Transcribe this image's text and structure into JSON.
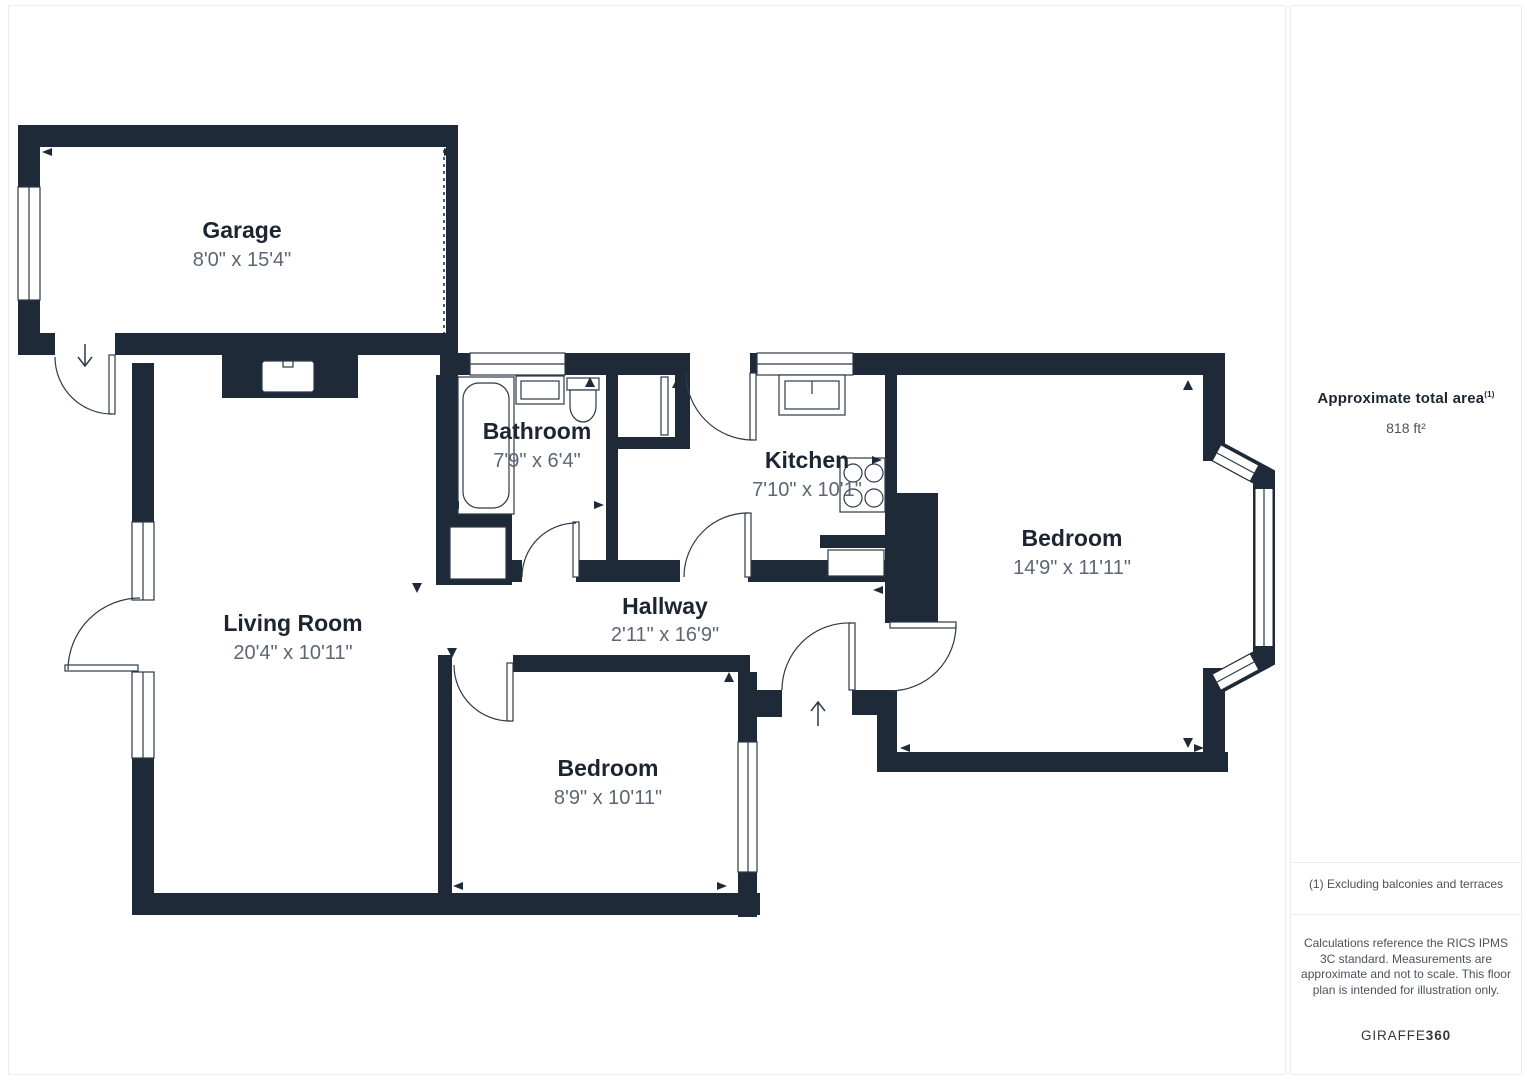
{
  "plan": {
    "wall_color": "#1f2a38",
    "rooms": [
      {
        "id": "garage",
        "name": "Garage",
        "dims": "8'0\" x 15'4\""
      },
      {
        "id": "bathroom",
        "name": "Bathroom",
        "dims": "7'9\" x 6'4\""
      },
      {
        "id": "kitchen",
        "name": "Kitchen",
        "dims": "7'10\" x 10'1\""
      },
      {
        "id": "bedroom-1",
        "name": "Bedroom",
        "dims": "14'9\" x 11'11\""
      },
      {
        "id": "living-room",
        "name": "Living Room",
        "dims": "20'4\" x 10'11\""
      },
      {
        "id": "hallway",
        "name": "Hallway",
        "dims": "2'11\" x 16'9\""
      },
      {
        "id": "bedroom-2",
        "name": "Bedroom",
        "dims": "8'9\" x 10'11\""
      }
    ]
  },
  "sidebar": {
    "area_label": "Approximate total area",
    "area_footnote_marker": "(1)",
    "area_value": "818 ft²",
    "footnote": "(1) Excluding balconies and terraces",
    "disclaimer": "Calculations reference the RICS IPMS 3C standard. Measurements are approximate and not to scale. This floor plan is intended for illustration only.",
    "brand_name": "GIRAFFE",
    "brand_suffix": "360"
  }
}
